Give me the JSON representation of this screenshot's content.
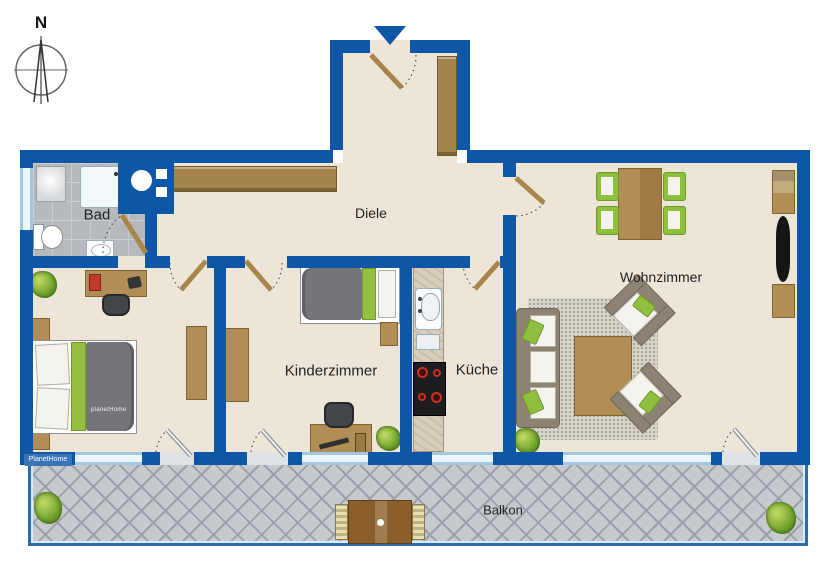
{
  "compass": {
    "label": "N"
  },
  "watermarks": {
    "corner": "PlanetHome",
    "bed": "planetHome"
  },
  "rooms": [
    {
      "id": "bad",
      "label": "Bad",
      "furniture": [
        "window",
        "washing-machine",
        "shower",
        "toilet",
        "sink",
        "door"
      ]
    },
    {
      "id": "diele",
      "label": "Diele",
      "furniture": [
        "wardrobe",
        "entrance-door",
        "hall-wardrobe"
      ]
    },
    {
      "id": "bedroom",
      "label": "",
      "furniture": [
        "double-bed",
        "nightstand",
        "nightstand",
        "desk",
        "desk-chair",
        "wardrobe",
        "plant",
        "balcony-door",
        "window"
      ]
    },
    {
      "id": "kinderzimmer",
      "label": "Kinderzimmer",
      "furniture": [
        "single-bed",
        "nightstand",
        "wardrobe",
        "desk",
        "desk-chair",
        "plant",
        "balcony-door",
        "window"
      ]
    },
    {
      "id": "kueche",
      "label": "Küche",
      "furniture": [
        "kitchen-counter",
        "sink",
        "stove",
        "window",
        "door"
      ]
    },
    {
      "id": "wohnzimmer",
      "label": "Wohnzimmer",
      "furniture": [
        "dining-table",
        "dining-chair",
        "dining-chair",
        "dining-chair",
        "dining-chair",
        "shelf",
        "tv",
        "sideboard",
        "sofa",
        "armchair",
        "armchair",
        "coffee-table",
        "rug",
        "plant",
        "balcony-door",
        "window"
      ]
    },
    {
      "id": "balkon",
      "label": "Balkon",
      "furniture": [
        "bistro-table",
        "chair",
        "chair",
        "plant",
        "plant"
      ]
    }
  ],
  "colors": {
    "wall": "#0d57a6",
    "floor": "#ece5d8",
    "bath_tile": "#b5b9bd",
    "balcony_tile": "#c6c9ce",
    "wood": "#b18e55",
    "accent_green": "#8fbf3e",
    "blanket_gray": "#737578",
    "window": "#eaf5fc"
  }
}
